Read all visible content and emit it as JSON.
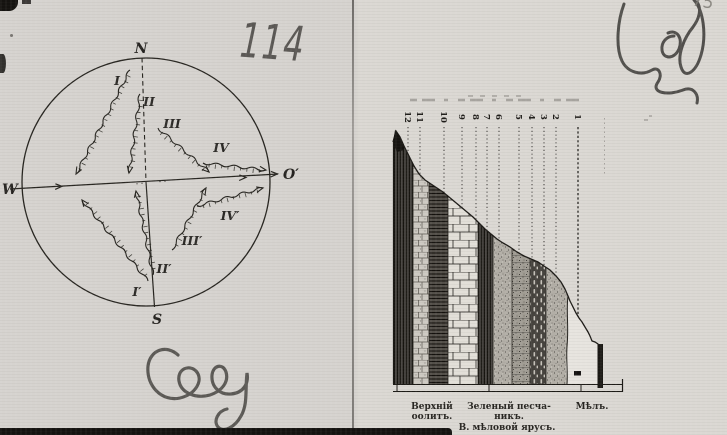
{
  "annotations": {
    "page_number": "114",
    "corner_number": "75"
  },
  "compass": {
    "cardinal": {
      "north": "N",
      "west": "W",
      "east": "O′",
      "south": "S"
    },
    "rays": [
      {
        "label": "I"
      },
      {
        "label": "II"
      },
      {
        "label": "III"
      },
      {
        "label": "IV"
      },
      {
        "label": "I′"
      },
      {
        "label": "II′"
      },
      {
        "label": "III′"
      },
      {
        "label": "IV′"
      }
    ]
  },
  "section": {
    "column_numbers": [
      "12",
      "11",
      "10",
      "9",
      "8",
      "7",
      "6",
      "5",
      "4",
      "3",
      "2",
      "1"
    ],
    "labels": {
      "left_line1": "Верхній",
      "left_line2": "оолитъ.",
      "middle_line1": "Зеленый песча-",
      "middle_line2": "никъ.",
      "right": "Мѣлъ.",
      "bottom": "В. мѣловой ярусъ."
    }
  },
  "colors": {
    "paper": "#dbd8d3",
    "ink": "#24221f",
    "pencil": "#45433f"
  }
}
